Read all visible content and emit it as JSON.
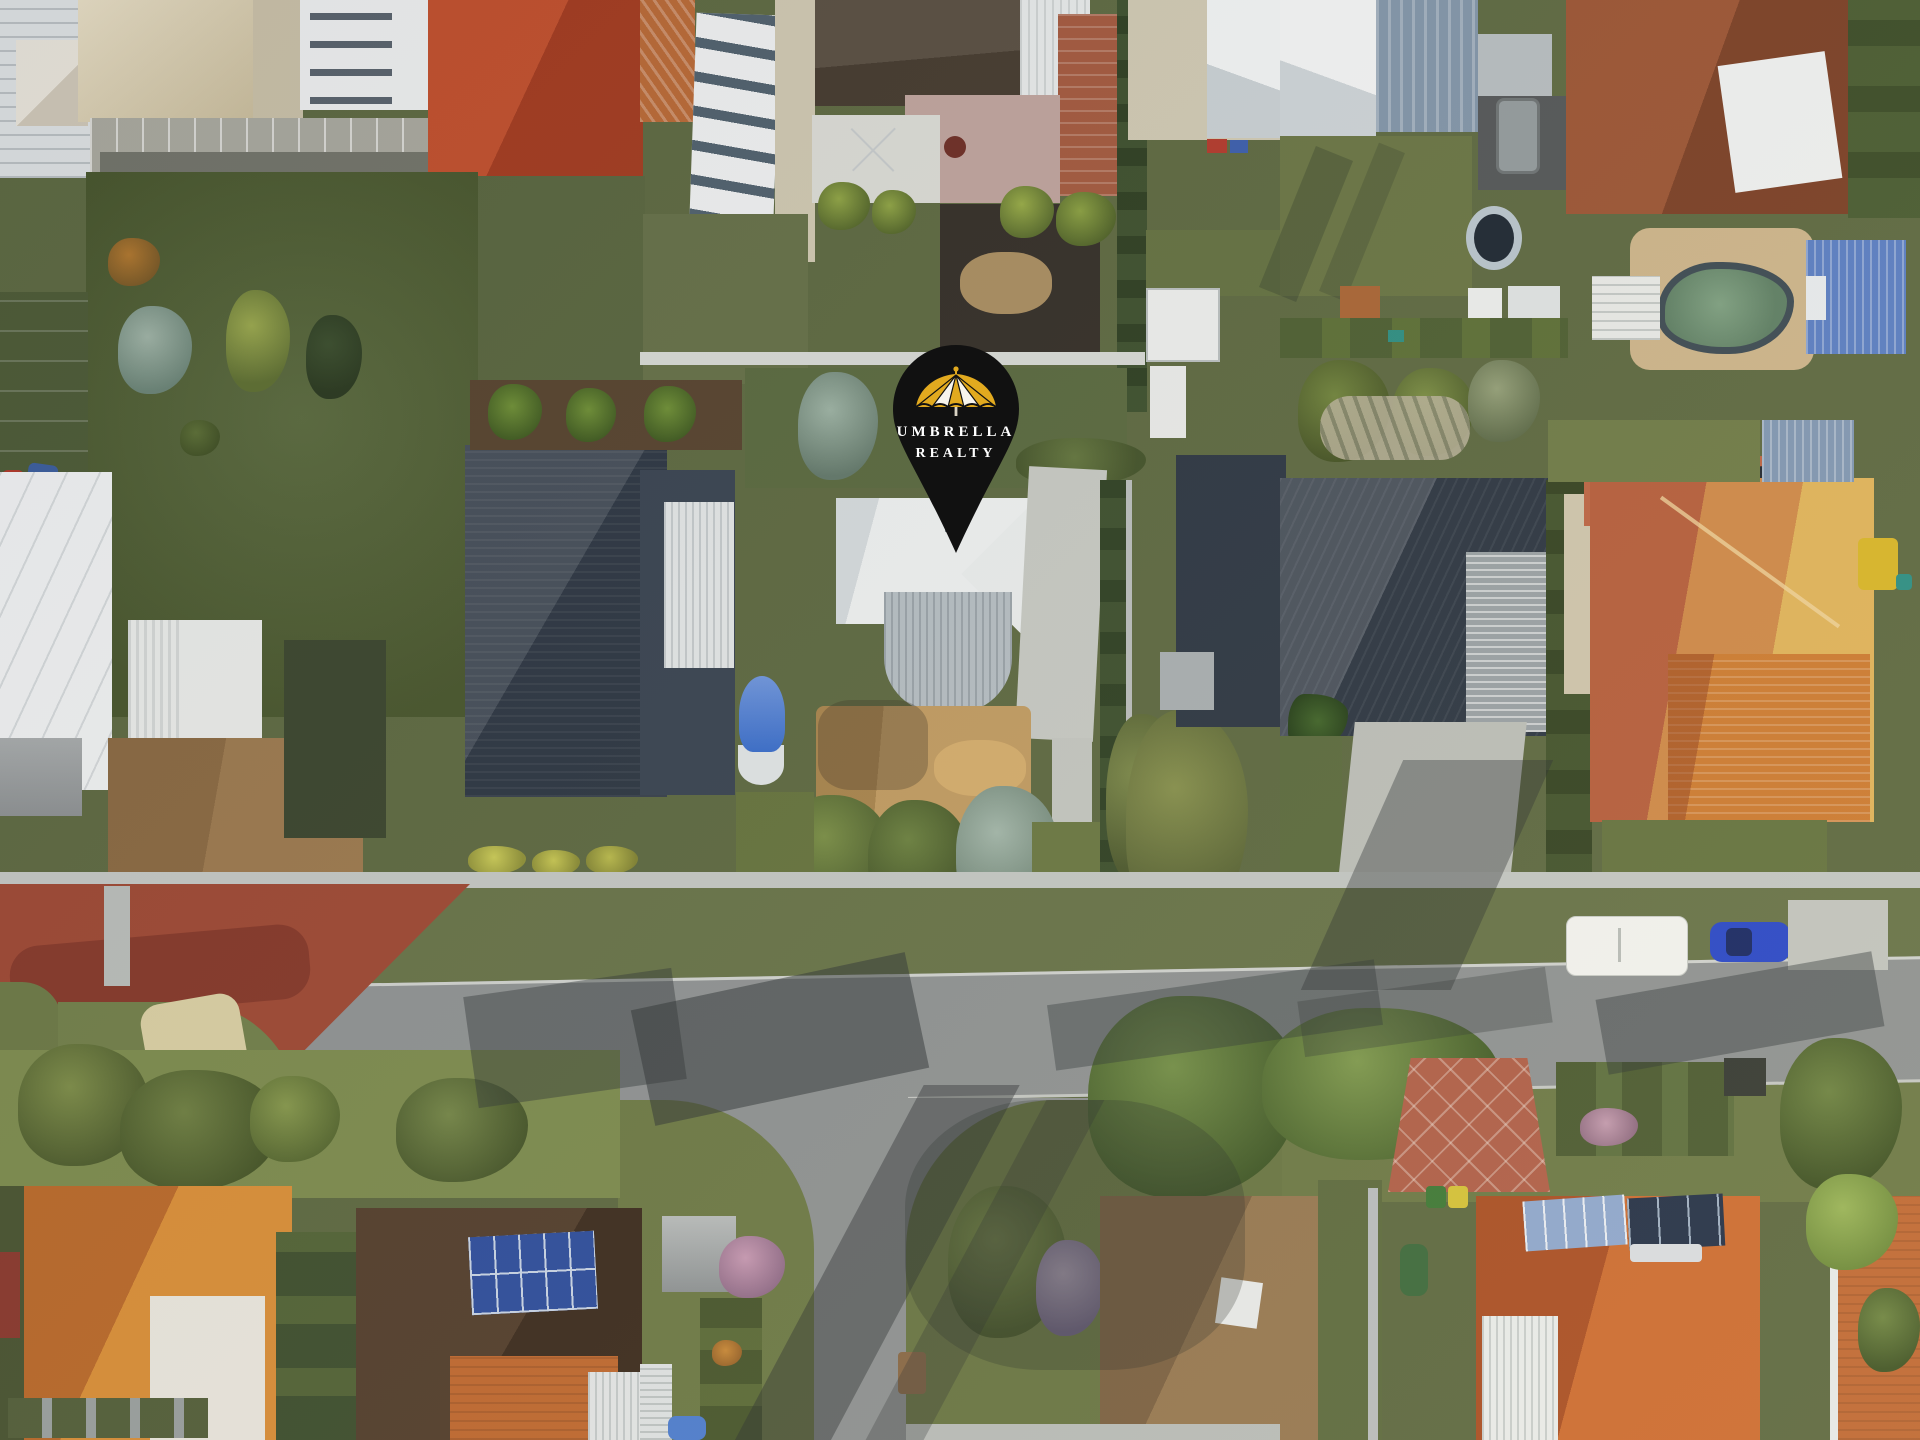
{
  "marker": {
    "line1": "UMBRELLA",
    "line2": "REALTY",
    "icon": "umbrella-logo",
    "shape": "location-pin"
  },
  "colors": {
    "pin_black": "#111111",
    "umbrella_yellow": "#e2aa1f",
    "umbrella_white": "#f7f4ec",
    "pin_text": "#ffffff",
    "road_grey": "#8f9394",
    "road_red": "#9e4a36",
    "footpath": "#c3c7c4",
    "concrete": "#c6c9c4",
    "lawn_green": "#5e6a43",
    "lawn_bright": "#7d8c50",
    "roof_white": "#edf0f1",
    "roof_navy": "#2e3845",
    "roof_red": "#b8492b",
    "roof_orange": "#cd7c33",
    "roof_orange_lit": "#e0b45c",
    "roof_brown": "#8f5138",
    "roof_tan": "#8a6b4a",
    "veranda_grey": "#b5bec4",
    "pool_teal": "#5f8066",
    "shed_blue": "#5b7fc4",
    "solar_blue": "#2f4f9e",
    "car_blue": "#2b49c9",
    "caravan_white": "#f2f3f0",
    "sand_tan": "#c19c63",
    "dirt_brown": "#9c7a50"
  }
}
